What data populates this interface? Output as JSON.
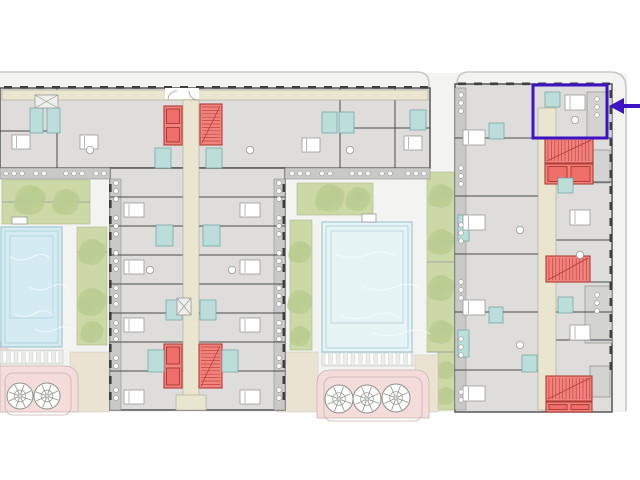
{
  "canvas": {
    "width": 640,
    "height": 480,
    "background": "#ffffff"
  },
  "colors": {
    "site": "#f3f3f1",
    "road": "#c8c8c6",
    "building_fill": "#dedddb",
    "building_stroke": "#565656",
    "balcony_fill": "#c9c9c7",
    "balcony_stroke": "#8f8f8d",
    "protrusion_fill": "#d3d3d1",
    "corridor_fill": "#e9e5cf",
    "corridor_stroke": "#a8a697",
    "wall": "#4a4a4a",
    "wall_light": "#9a9a98",
    "window_dash": "#3f3f3f",
    "red_fill": "#f1837f",
    "red_stroke": "#b23c36",
    "red_hatch": "#c4443c",
    "teal_fill": "#bcdeda",
    "teal_stroke": "#6da39e",
    "garden_fill": "#ccd8a6",
    "garden_stroke": "#aebc8a",
    "tree_fill": "#b9cc90",
    "pool_left_fill": "#d4ecf1",
    "pool_center_fill": "#e6f4f6",
    "pool_stroke": "#a3c9d0",
    "pergola_fill": "#ebebe9",
    "tan_fill": "#eae3d2",
    "pink_fill": "#f3dcda",
    "pink_stroke": "#c9b2b0",
    "furniture_fill": "#ffffff",
    "furniture_stroke": "#9a9a98",
    "highlight": "#3e13c4"
  },
  "site_bg": [
    0,
    73,
    627,
    339
  ],
  "roads": [
    "M0,72 H417 Q429,72 429,84 V88",
    "M457,88 V84 Q457,72 469,72 H610 Q626,72 626,88 V411"
  ],
  "gardens": [
    [
      2,
      180,
      88,
      44
    ],
    [
      77,
      227,
      30,
      118
    ],
    [
      297,
      183,
      76,
      32
    ],
    [
      290,
      220,
      22,
      130
    ],
    [
      427,
      172,
      28,
      180
    ],
    [
      438,
      352,
      17,
      58
    ]
  ],
  "trees": [
    [
      30,
      200,
      15
    ],
    [
      66,
      202,
      13
    ],
    [
      92,
      252,
      13
    ],
    [
      92,
      302,
      14
    ],
    [
      92,
      332,
      11
    ],
    [
      330,
      198,
      14
    ],
    [
      358,
      199,
      12
    ],
    [
      300,
      252,
      11
    ],
    [
      300,
      302,
      12
    ],
    [
      300,
      336,
      10
    ],
    [
      441,
      196,
      12
    ],
    [
      441,
      242,
      13
    ],
    [
      441,
      288,
      13
    ],
    [
      441,
      332,
      12
    ],
    [
      446,
      370,
      9
    ],
    [
      446,
      396,
      9
    ]
  ],
  "garden_dividers": [
    [
      77,
      252,
      107,
      252
    ],
    [
      427,
      262,
      455,
      262
    ],
    [
      427,
      352,
      455,
      352
    ],
    [
      2,
      202,
      90,
      202
    ]
  ],
  "tan_paths": [
    [
      70,
      352,
      40,
      60
    ],
    [
      277,
      352,
      41,
      60
    ],
    [
      415,
      355,
      23,
      57
    ]
  ],
  "pink_paths": [
    {
      "outer": [
        0,
        366,
        78,
        46
      ],
      "radius": "0 14 0 0",
      "inner": [
        5,
        373,
        66,
        42
      ]
    },
    {
      "outer": [
        317,
        370,
        112,
        48
      ],
      "radius": "14 14 0 0",
      "inner": [
        324,
        377,
        98,
        44
      ]
    }
  ],
  "pink_wedge": [
    [
      0,
      342
    ],
    [
      11,
      352
    ],
    [
      0,
      365
    ]
  ],
  "palms": [
    {
      "cx": 20,
      "cy": 396,
      "r": 13
    },
    {
      "cx": 47,
      "cy": 396,
      "r": 13
    },
    {
      "cx": 339,
      "cy": 399,
      "r": 14
    },
    {
      "cx": 367,
      "cy": 399,
      "r": 14
    },
    {
      "cx": 396,
      "cy": 398,
      "r": 14
    }
  ],
  "pergolas": [
    [
      0,
      350,
      63,
      14
    ],
    [
      322,
      352,
      91,
      14
    ]
  ],
  "pools": [
    {
      "rect": [
        1,
        227,
        61,
        120
      ],
      "fill": "pool_left_fill",
      "ladder": [
        12,
        217,
        15,
        7
      ]
    },
    {
      "rect": [
        322,
        222,
        90,
        130
      ],
      "fill": "pool_center_fill",
      "ladder": [
        362,
        214,
        14,
        8
      ]
    }
  ],
  "buildings": [
    [
      0,
      88,
      430,
      80
    ],
    [
      110,
      168,
      175,
      242
    ],
    [
      455,
      84,
      157,
      328
    ]
  ],
  "balconies": [
    [
      0,
      168,
      110,
      11
    ],
    [
      285,
      168,
      145,
      11
    ],
    [
      110,
      179,
      11,
      231
    ],
    [
      274,
      179,
      11,
      231
    ],
    [
      455,
      88,
      11,
      322
    ]
  ],
  "protrusions": [
    [
      587,
      92,
      25,
      46
    ],
    [
      590,
      150,
      20,
      33
    ],
    [
      585,
      286,
      27,
      57
    ],
    [
      590,
      366,
      20,
      31
    ]
  ],
  "walls": [
    [
      57,
      88,
      57,
      168
    ],
    [
      340,
      88,
      340,
      168
    ],
    [
      395,
      88,
      395,
      168
    ],
    [
      0,
      131,
      57,
      131
    ],
    [
      340,
      128,
      430,
      128
    ],
    [
      110,
      197,
      183,
      197
    ],
    [
      199,
      197,
      285,
      197
    ],
    [
      110,
      226,
      183,
      226
    ],
    [
      199,
      226,
      285,
      226
    ],
    [
      110,
      255,
      183,
      255
    ],
    [
      199,
      255,
      285,
      255
    ],
    [
      110,
      284,
      183,
      284
    ],
    [
      199,
      284,
      285,
      284
    ],
    [
      110,
      313,
      183,
      313
    ],
    [
      199,
      313,
      285,
      313
    ],
    [
      110,
      342,
      183,
      342
    ],
    [
      199,
      342,
      285,
      342
    ],
    [
      110,
      371,
      183,
      371
    ],
    [
      199,
      371,
      285,
      371
    ],
    [
      455,
      138,
      538,
      138
    ],
    [
      455,
      196,
      538,
      196
    ],
    [
      455,
      254,
      538,
      254
    ],
    [
      455,
      312,
      538,
      312
    ],
    [
      455,
      370,
      538,
      370
    ],
    [
      556,
      138,
      612,
      138
    ],
    [
      556,
      182,
      612,
      182
    ],
    [
      556,
      240,
      612,
      240
    ],
    [
      556,
      282,
      612,
      282
    ],
    [
      556,
      312,
      612,
      312
    ],
    [
      556,
      340,
      612,
      340
    ]
  ],
  "window_dash_runs": [
    {
      "x": 4,
      "y": 86,
      "len": 424,
      "step": 16,
      "size": 8,
      "axis": "h"
    },
    {
      "x": 458,
      "y": 82.5,
      "len": 150,
      "step": 16,
      "size": 8,
      "axis": "h"
    },
    {
      "x": 109,
      "y": 184,
      "len": 220,
      "step": 16,
      "size": 8,
      "axis": "v"
    },
    {
      "x": 282.5,
      "y": 184,
      "len": 220,
      "step": 16,
      "size": 8,
      "axis": "v"
    },
    {
      "x": 609.5,
      "y": 90,
      "len": 276,
      "step": 16,
      "size": 8,
      "axis": "v"
    }
  ],
  "corridors": [
    [
      2,
      90,
      426,
      10
    ],
    [
      183,
      100,
      16,
      308
    ],
    [
      176,
      395,
      30,
      15
    ],
    [
      538,
      108,
      18,
      302
    ]
  ],
  "entry_gap": [
    165,
    88,
    34,
    11
  ],
  "entry_arcs": [
    "M168,100 a9,9 0 0 1 9,-9",
    "M198,100 a9,9 0 0 1 -9,-9"
  ],
  "red_blocks": [
    {
      "type": "elevator",
      "x": 164,
      "y": 106,
      "w": 18,
      "h": 39,
      "cars": "v2"
    },
    {
      "type": "stair",
      "x": 200,
      "y": 104,
      "w": 22,
      "h": 41,
      "treads": "h"
    },
    {
      "type": "elevator",
      "x": 164,
      "y": 344,
      "w": 18,
      "h": 44,
      "cars": "v2"
    },
    {
      "type": "stair",
      "x": 199,
      "y": 344,
      "w": 23,
      "h": 44,
      "treads": "h"
    },
    {
      "type": "stair",
      "x": 545,
      "y": 138,
      "w": 48,
      "h": 25,
      "treads": "v"
    },
    {
      "type": "elevator",
      "x": 545,
      "y": 164,
      "w": 48,
      "h": 20,
      "cars": "h2"
    },
    {
      "type": "stair",
      "x": 546,
      "y": 256,
      "w": 44,
      "h": 26,
      "treads": "v"
    },
    {
      "type": "stair",
      "x": 546,
      "y": 376,
      "w": 46,
      "h": 25,
      "treads": "v"
    },
    {
      "type": "elevator",
      "x": 546,
      "y": 402,
      "w": 46,
      "h": 10,
      "cars": "h2"
    }
  ],
  "bathrooms": [
    [
      30,
      108,
      13,
      25
    ],
    [
      47,
      108,
      13,
      25
    ],
    [
      322,
      112,
      15,
      21
    ],
    [
      339,
      112,
      15,
      21
    ],
    [
      410,
      110,
      16,
      20
    ],
    [
      155,
      148,
      16,
      20
    ],
    [
      206,
      148,
      16,
      20
    ],
    [
      156,
      225,
      17,
      21
    ],
    [
      203,
      225,
      17,
      21
    ],
    [
      166,
      300,
      16,
      20
    ],
    [
      200,
      300,
      16,
      20
    ],
    [
      148,
      350,
      16,
      22
    ],
    [
      222,
      350,
      16,
      22
    ],
    [
      545,
      92,
      15,
      15
    ],
    [
      489,
      123,
      15,
      16
    ],
    [
      458,
      215,
      11,
      26
    ],
    [
      489,
      307,
      14,
      16
    ],
    [
      458,
      330,
      11,
      27
    ],
    [
      558,
      178,
      15,
      15
    ],
    [
      558,
      297,
      15,
      16
    ],
    [
      522,
      355,
      15,
      17
    ]
  ],
  "beds": [
    [
      12,
      135,
      18,
      14
    ],
    [
      80,
      135,
      18,
      14
    ],
    [
      302,
      138,
      18,
      14
    ],
    [
      404,
      136,
      18,
      14
    ],
    [
      124,
      203,
      20,
      14
    ],
    [
      240,
      203,
      20,
      14
    ],
    [
      124,
      260,
      20,
      14
    ],
    [
      240,
      260,
      20,
      14
    ],
    [
      124,
      318,
      20,
      14
    ],
    [
      240,
      318,
      20,
      14
    ],
    [
      124,
      390,
      20,
      14
    ],
    [
      240,
      390,
      20,
      14
    ],
    [
      463,
      130,
      22,
      15
    ],
    [
      463,
      215,
      22,
      15
    ],
    [
      463,
      300,
      22,
      15
    ],
    [
      463,
      386,
      22,
      15
    ],
    [
      565,
      95,
      20,
      15
    ],
    [
      570,
      210,
      20,
      15
    ],
    [
      570,
      325,
      20,
      15
    ]
  ],
  "tables": [
    [
      90,
      150
    ],
    [
      250,
      150
    ],
    [
      350,
      150
    ],
    [
      150,
      270
    ],
    [
      232,
      270
    ],
    [
      520,
      230
    ],
    [
      520,
      345
    ],
    [
      580,
      255
    ],
    [
      575,
      120
    ]
  ],
  "x_rects": [
    [
      35,
      95,
      23,
      13
    ],
    [
      177,
      298,
      14,
      17
    ]
  ],
  "balcony_dot_groups": [
    {
      "x": 6,
      "y": 173.5,
      "n": 3,
      "axis": "h"
    },
    {
      "x": 36,
      "y": 173.5,
      "n": 2,
      "axis": "h"
    },
    {
      "x": 66,
      "y": 173.5,
      "n": 3,
      "axis": "h"
    },
    {
      "x": 96,
      "y": 173.5,
      "n": 2,
      "axis": "h"
    },
    {
      "x": 292,
      "y": 173.5,
      "n": 3,
      "axis": "h"
    },
    {
      "x": 322,
      "y": 173.5,
      "n": 2,
      "axis": "h"
    },
    {
      "x": 352,
      "y": 173.5,
      "n": 3,
      "axis": "h"
    },
    {
      "x": 382,
      "y": 173.5,
      "n": 2,
      "axis": "h"
    },
    {
      "x": 408,
      "y": 173.5,
      "n": 3,
      "axis": "h"
    },
    {
      "x": 116,
      "y": 183,
      "n": 3,
      "axis": "v"
    },
    {
      "x": 116,
      "y": 218,
      "n": 3,
      "axis": "v"
    },
    {
      "x": 116,
      "y": 253,
      "n": 3,
      "axis": "v"
    },
    {
      "x": 116,
      "y": 288,
      "n": 3,
      "axis": "v"
    },
    {
      "x": 116,
      "y": 323,
      "n": 3,
      "axis": "v"
    },
    {
      "x": 116,
      "y": 358,
      "n": 2,
      "axis": "v"
    },
    {
      "x": 116,
      "y": 390,
      "n": 2,
      "axis": "v"
    },
    {
      "x": 279,
      "y": 183,
      "n": 3,
      "axis": "v"
    },
    {
      "x": 279,
      "y": 218,
      "n": 3,
      "axis": "v"
    },
    {
      "x": 279,
      "y": 253,
      "n": 3,
      "axis": "v"
    },
    {
      "x": 279,
      "y": 288,
      "n": 3,
      "axis": "v"
    },
    {
      "x": 279,
      "y": 323,
      "n": 3,
      "axis": "v"
    },
    {
      "x": 279,
      "y": 358,
      "n": 2,
      "axis": "v"
    },
    {
      "x": 279,
      "y": 390,
      "n": 2,
      "axis": "v"
    },
    {
      "x": 461,
      "y": 95,
      "n": 3,
      "axis": "v"
    },
    {
      "x": 461,
      "y": 168,
      "n": 3,
      "axis": "v"
    },
    {
      "x": 461,
      "y": 225,
      "n": 3,
      "axis": "v"
    },
    {
      "x": 461,
      "y": 282,
      "n": 3,
      "axis": "v"
    },
    {
      "x": 461,
      "y": 339,
      "n": 3,
      "axis": "v"
    },
    {
      "x": 461,
      "y": 392,
      "n": 2,
      "axis": "v"
    },
    {
      "x": 597,
      "y": 99,
      "n": 3,
      "axis": "v"
    },
    {
      "x": 597,
      "y": 295,
      "n": 3,
      "axis": "v"
    }
  ],
  "highlight": {
    "box": {
      "x": 533,
      "y": 85,
      "w": 74,
      "h": 53,
      "stroke_width": 3
    },
    "arrow": {
      "shaft_x1": 640,
      "shaft_x2": 623,
      "y": 106,
      "head_tip_x": 609,
      "head_half": 8,
      "head_back_x": 624
    }
  }
}
